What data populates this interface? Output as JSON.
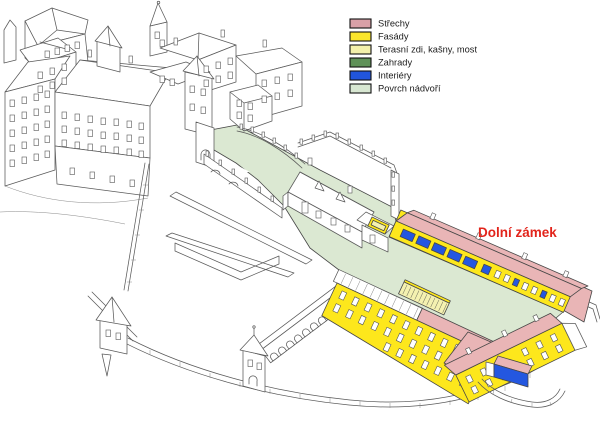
{
  "title": "Castle site isometric plan",
  "legend": {
    "items": [
      {
        "id": "strechy",
        "label": "Střechy",
        "color": "#d9a0a7"
      },
      {
        "id": "fasady",
        "label": "Fasády",
        "color": "#fbe62c"
      },
      {
        "id": "terasni",
        "label": "Terasní zdi, kašny, most",
        "color": "#f3f0ab"
      },
      {
        "id": "zahrady",
        "label": "Zahrady",
        "color": "#5f9158"
      },
      {
        "id": "interiery",
        "label": "Interiéry",
        "color": "#2155dd"
      },
      {
        "id": "povrch",
        "label": "Povrch nádvoří",
        "color": "#d8e7d2"
      }
    ]
  },
  "annotation": {
    "label": "Dolní zámek",
    "color": "#e2241b"
  },
  "drawing": {
    "colors": {
      "roof": "#e9b5b6",
      "facade": "#fde71c",
      "terrace": "#f4f1b0",
      "interior": "#2457e0",
      "courtyard": "#dbe8d2"
    }
  }
}
